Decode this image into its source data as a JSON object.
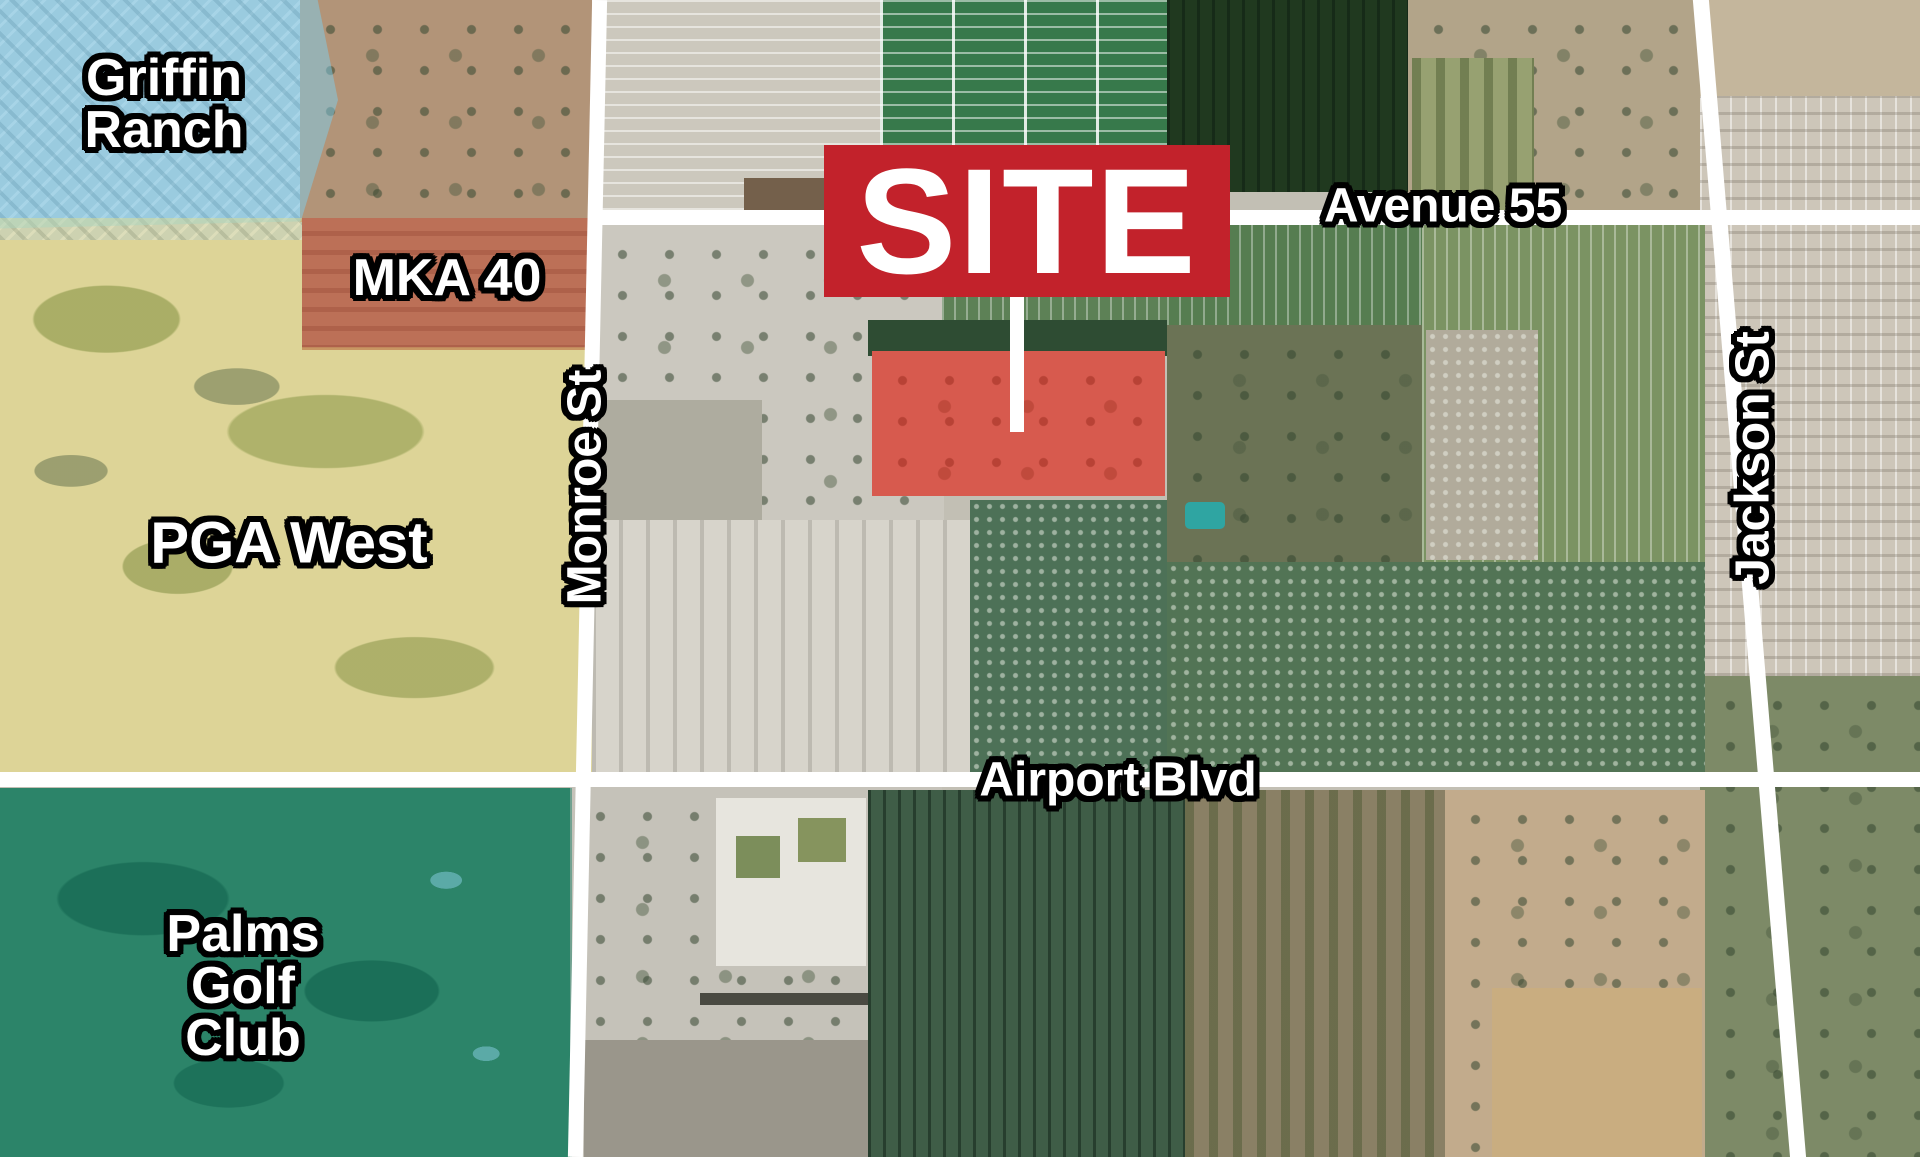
{
  "title": "Aerial site location map",
  "labels": {
    "site": "SITE",
    "avenue_55": "Avenue 55",
    "monroe_st": "Monroe St",
    "jackson_st": "Jackson St",
    "airport_blvd": "Airport Blvd",
    "mka_40": "MKA 40",
    "pga_west": "PGA West",
    "griffin_line1": "Griffin",
    "griffin_line2": "Ranch",
    "palms_line1": "Palms",
    "palms_line2": "Golf",
    "palms_line3": "Club"
  },
  "colors": {
    "site_banner_bg": "#c2222b",
    "site_banner_text": "#ffffff",
    "site_highlight": "rgba(225,32,25,0.62)",
    "griffin_tint": "rgba(125,205,235,0.50)",
    "mka_tint": "rgba(210,100,75,0.45)",
    "pga_tint": "rgba(235,225,130,0.42)",
    "palms_tint": "rgba(20,125,100,0.48)",
    "road": "#ffffff",
    "label_text": "#ffffff",
    "label_outline": "#000000"
  },
  "regions": [
    {
      "label": "Griffin Ranch",
      "tint": "light blue"
    },
    {
      "label": "MKA 40",
      "tint": "salmon"
    },
    {
      "label": "PGA West",
      "tint": "yellow"
    },
    {
      "label": "Palms Golf Club",
      "tint": "teal green"
    },
    {
      "label": "SITE",
      "tint": "red"
    }
  ],
  "roads": [
    "Avenue 55",
    "Monroe St",
    "Jackson St",
    "Airport Blvd"
  ]
}
